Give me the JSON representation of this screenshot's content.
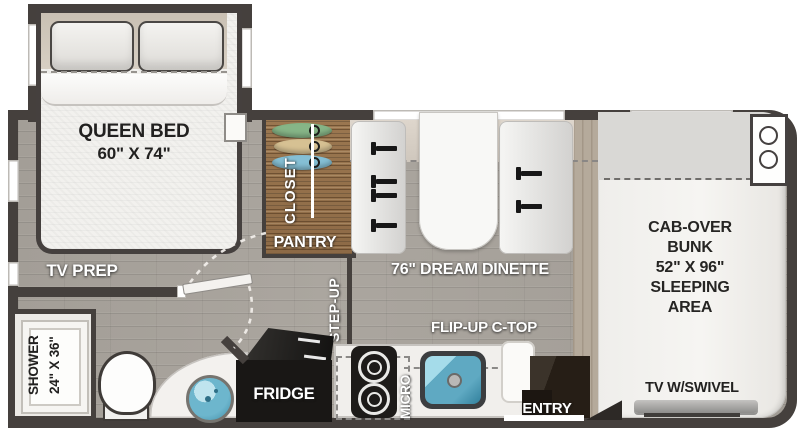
{
  "colors": {
    "wall": "#45403d",
    "floor_gray": "#a5a099",
    "closet_wood": "#96734c",
    "bed_white": "#f2f1ee",
    "sink_blue": "#5fa9c2",
    "fridge_black": "#1a1816",
    "entry_brown": "#261e16",
    "label_white": "#ffffff",
    "label_black": "#222120",
    "hanger_green": "#86b587",
    "hanger_tan": "#d6c193",
    "hanger_blue": "#85bfd4"
  },
  "bedroom": {
    "bed_label": "QUEEN BED",
    "bed_size": "60\" X 74\"",
    "tv_prep_label": "TV PREP"
  },
  "bath": {
    "shower_label": "SHOWER",
    "shower_size": "24\" X 36\""
  },
  "storage": {
    "closet_label": "CLOSET",
    "pantry_label": "PANTRY"
  },
  "hall": {
    "step_up_label": "STEP-UP"
  },
  "dinette": {
    "label": "76\" DREAM DINETTE"
  },
  "kitchen": {
    "flip_up_label": "FLIP-UP C-TOP",
    "micro_label": "MICRO",
    "fridge_label": "FRIDGE",
    "entry_label": "ENTRY"
  },
  "bunk": {
    "lines": [
      "CAB-OVER",
      "BUNK",
      "52\" X 96\"",
      "SLEEPING",
      "AREA"
    ],
    "tv_label": "TV W/SWIVEL"
  }
}
